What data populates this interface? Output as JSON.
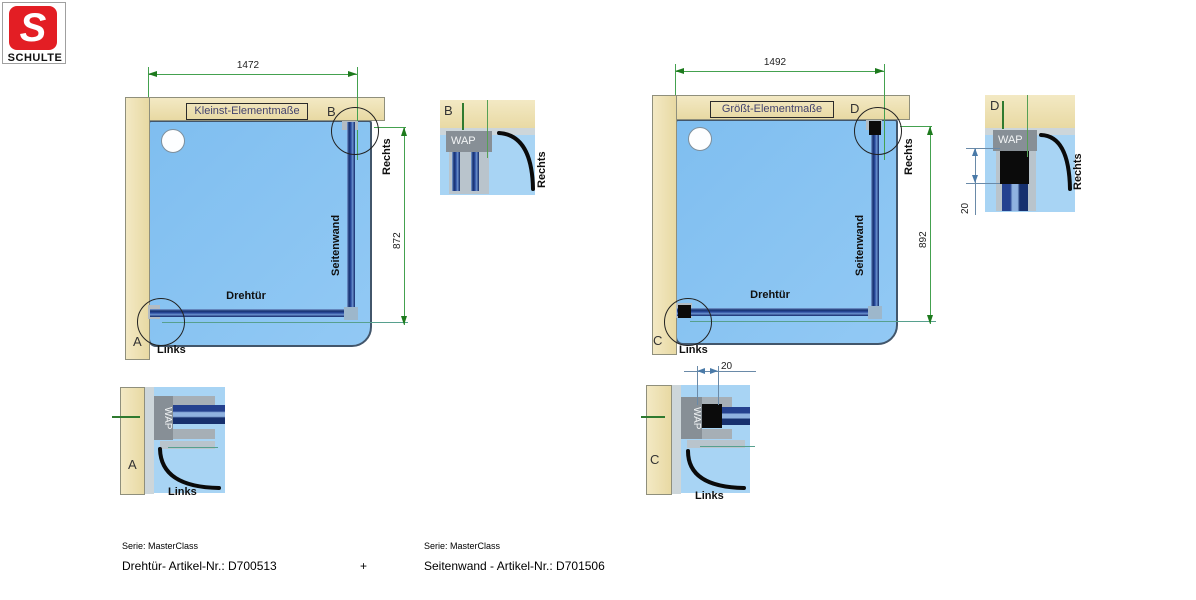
{
  "logo": {
    "letter": "S",
    "brand": "SCHULTE"
  },
  "left": {
    "title": "Kleinst-Elementmaße",
    "width": "1472",
    "height": "872",
    "door": "Drehtür",
    "sidewall": "Seitenwand",
    "rechts": "Rechts",
    "links": "Links",
    "corner_top": "B",
    "corner_bottom": "A"
  },
  "right": {
    "title": "Größt-Elementmaße",
    "width": "1492",
    "height": "892",
    "door": "Drehtür",
    "sidewall": "Seitenwand",
    "rechts": "Rechts",
    "links": "Links",
    "corner_top": "D",
    "corner_bottom": "C",
    "adjust": "20"
  },
  "details": {
    "a": {
      "letter": "A",
      "wap": "WAP",
      "side": "Links"
    },
    "b": {
      "letter": "B",
      "wap": "WAP",
      "side": "Rechts"
    },
    "c": {
      "letter": "C",
      "wap": "WAP",
      "side": "Links",
      "dim": "20"
    },
    "d": {
      "letter": "D",
      "wap": "WAP",
      "side": "Rechts",
      "dim": "20"
    }
  },
  "footer": {
    "left_serie": "Serie: MasterClass",
    "left_article": "Drehtür- Artikel-Nr.: D700513",
    "plus": "+",
    "right_serie": "Serie: MasterClass",
    "right_article": "Seitenwand - Artikel-Nr.: D701506"
  },
  "colors": {
    "brand_red": "#e31e24",
    "wall_beige": "#ebdfac",
    "tray_blue": "#8ac4f1",
    "profile_blue": "#24418f",
    "dimension_green": "#44a14f",
    "detail_dim_blue": "#6a8aa8"
  }
}
